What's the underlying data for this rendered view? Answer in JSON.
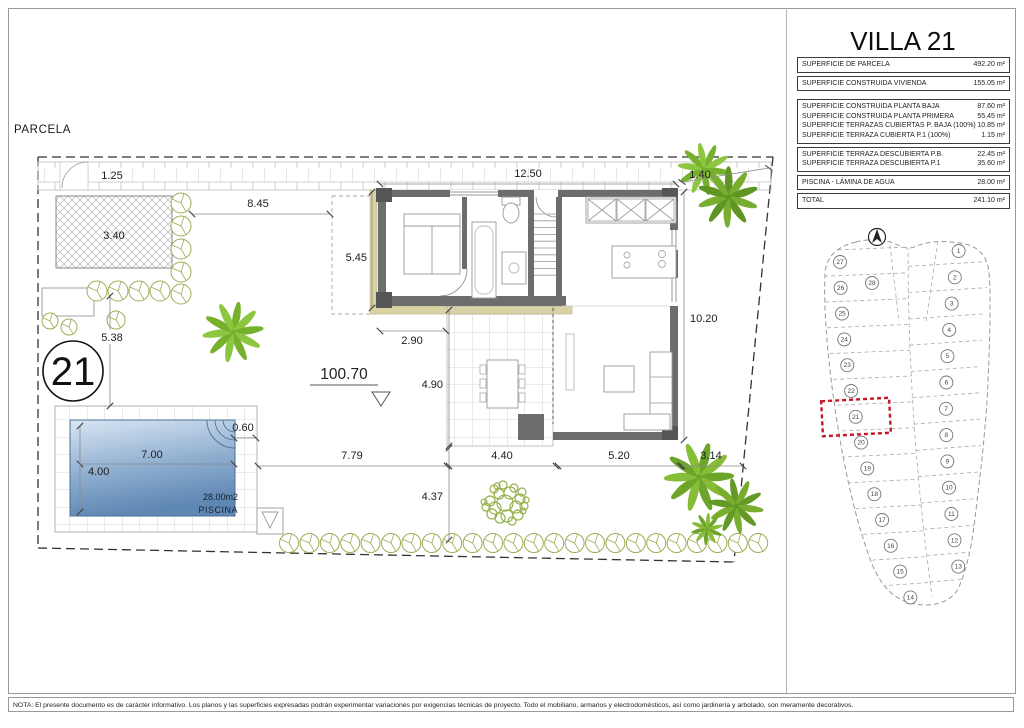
{
  "title": "VILLA 21",
  "surface_table": {
    "groups": [
      {
        "rows": [
          {
            "label": "SUPERFICIE DE PARCELA",
            "value": "492.20 m²"
          }
        ]
      },
      {
        "rows": [
          {
            "label": "SUPERFICIE CONSTRUIDA VIVIENDA",
            "value": "155.05 m²"
          }
        ]
      },
      {
        "rows": [
          {
            "label": "SUPERFICIE CONSTRUIDA PLANTA BAJA",
            "value": "87.60 m²"
          },
          {
            "label": "SUPERFICIE CONSTRUIDA PLANTA PRIMERA",
            "value": "55.45 m²"
          },
          {
            "label": "SUPERFICIE TERRAZAS CUBIERTAS P. BAJA (100%)",
            "value": "10.85 m²"
          },
          {
            "label": "SUPERFICIE TERRAZA CUBIERTA P.1 (100%)",
            "value": "1.15 m²"
          }
        ]
      },
      {
        "rows": [
          {
            "label": "SUPERFICIE TERRAZA DESCUBIERTA P.B.",
            "value": "22.45 m²"
          },
          {
            "label": "SUPERFICIE TERRAZA DESCUBIERTA P.1",
            "value": "35.60 m²"
          }
        ]
      },
      {
        "rows": [
          {
            "label": "PISCINA - LÁMINA DE AGUA",
            "value": "28.00 m²"
          }
        ]
      },
      {
        "rows": [
          {
            "label": "TOTAL",
            "value": "241.10 m²"
          }
        ]
      }
    ]
  },
  "plan": {
    "area_label": "PARCELA",
    "plot_number": "21",
    "elevation": "100.70",
    "pool": {
      "area": "28.00m2",
      "label": "PISCINA"
    },
    "dimensions": {
      "sidewalk": "1.25",
      "planter": "3.40",
      "left_gap": "8.45",
      "house_top": "12.50",
      "right_gap": "1.40",
      "house_left": "5.45",
      "bedroom": "2.90",
      "house_right": "10.20",
      "left_diag": "5.38",
      "terrace_h": "4.90",
      "bottom_margin": "4.37",
      "pool_to_house": "7.79",
      "terrace_w": "4.40",
      "living_w": "5.20",
      "right_margin": "3.14",
      "pool_step": "0.60",
      "pool_length": "7.00",
      "pool_width": "4.00"
    }
  },
  "site_map": {
    "highlighted_plot": "21",
    "top_plot": "28",
    "left_plots": [
      "27",
      "26",
      "25",
      "24",
      "23",
      "22",
      "21",
      "20",
      "19",
      "18",
      "17",
      "16",
      "15",
      "14"
    ],
    "right_plots": [
      "1",
      "2",
      "3",
      "4",
      "5",
      "6",
      "7",
      "8",
      "9",
      "10",
      "11",
      "12",
      "13"
    ]
  },
  "note": "NOTA: El presente documento es de carácter informativo. Los planos y las superficies expresadas podrán experimentar variaciones por exigencias técnicas de proyecto. Todo el mobiliario, armarios y electrodomésticos, así como jardinería y arbolado, son meramente decorativos.",
  "colors": {
    "wall": "#6d6d6d",
    "trim_beige": "#d8d2a4",
    "pool_light": "#d9e6f4",
    "pool_dark": "#5f87b4",
    "green_light": "#8dc63f",
    "green_dark": "#79ad2f",
    "highlight_red": "#c41627"
  }
}
